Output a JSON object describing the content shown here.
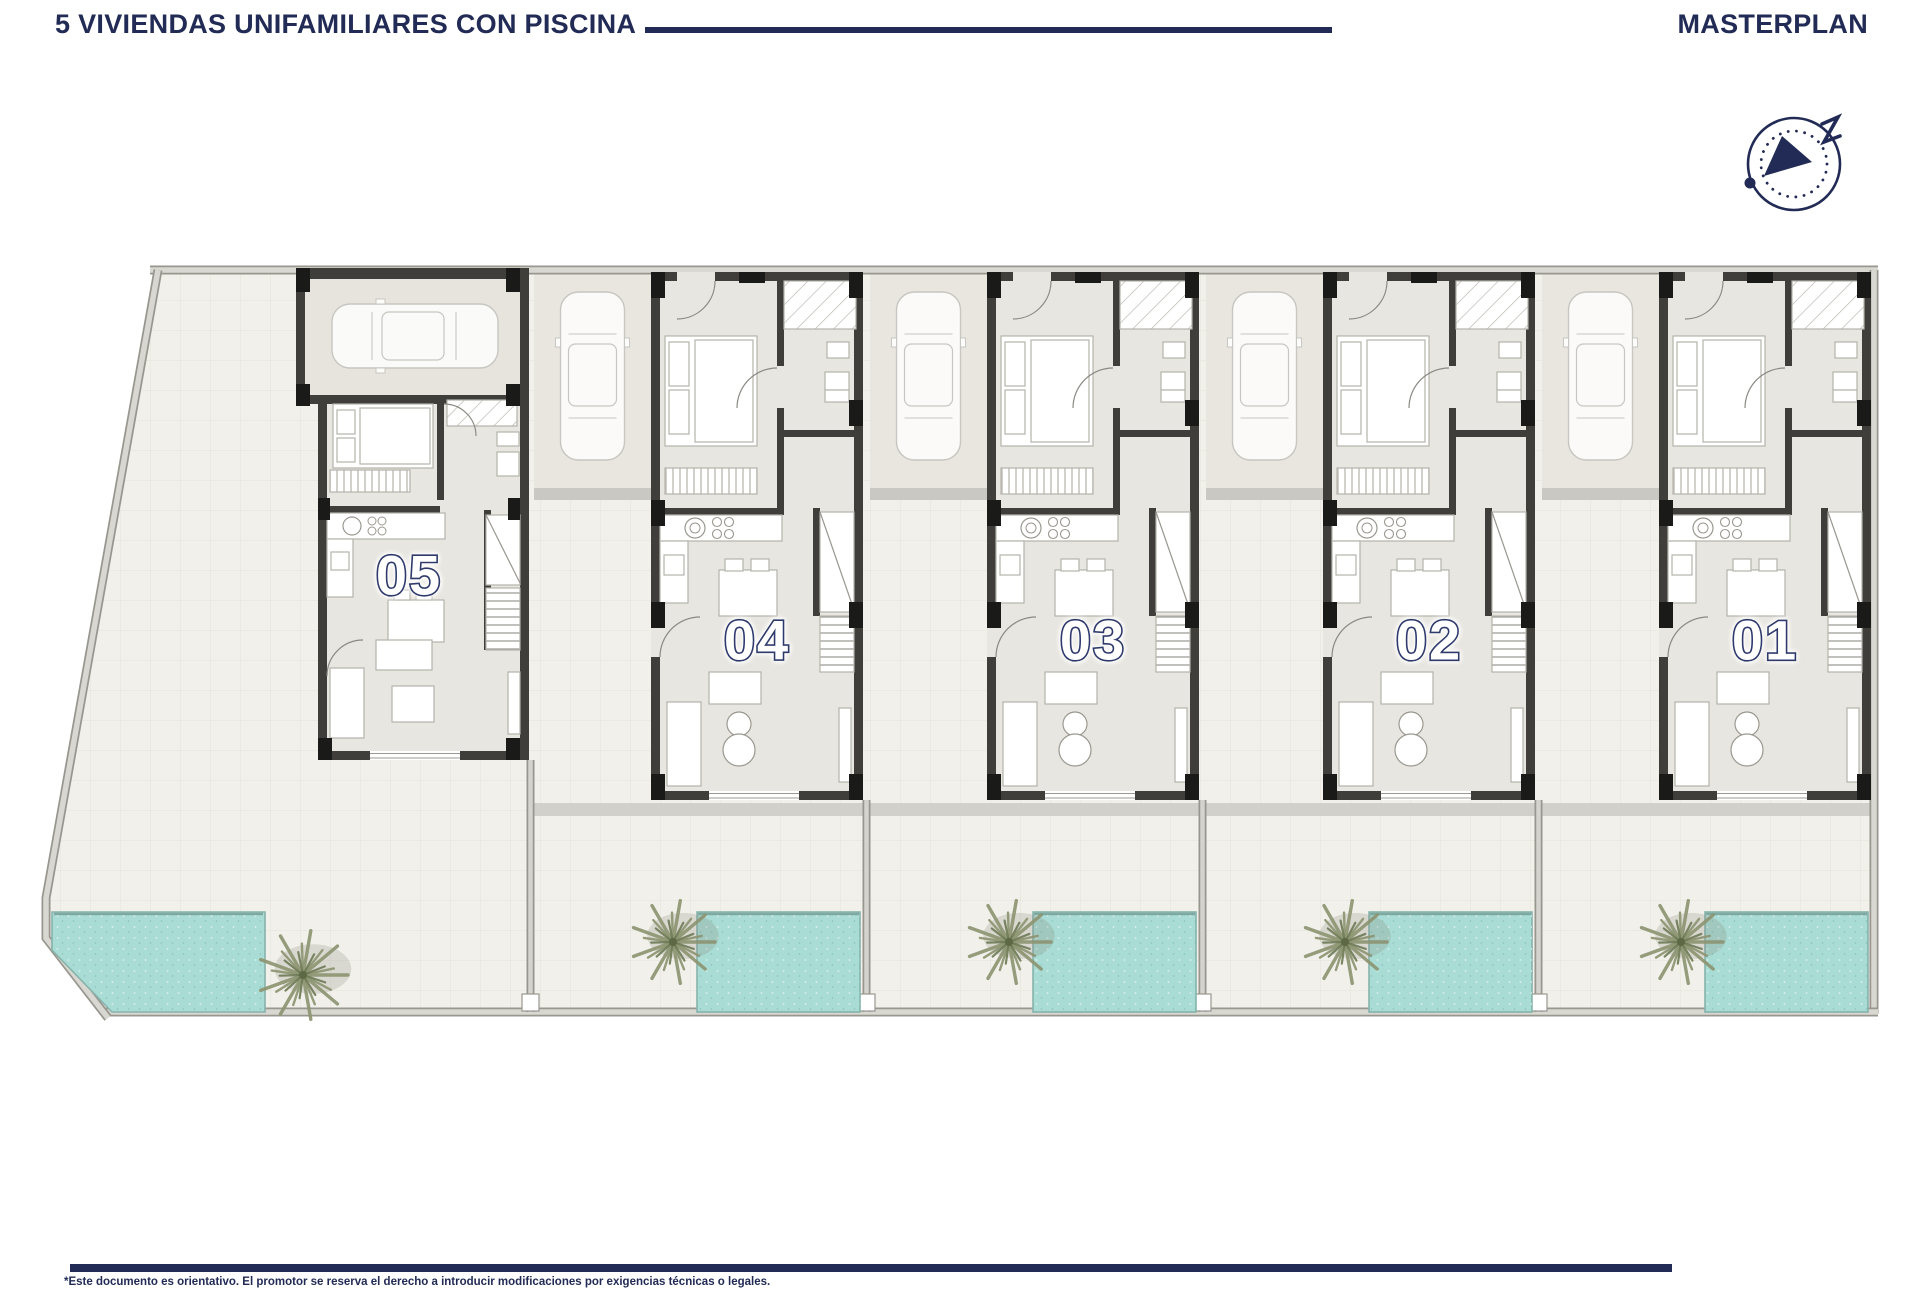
{
  "header": {
    "title": "5 VIVIENDAS UNIFAMILIARES CON PISCINA",
    "masterplan": "MASTERPLAN"
  },
  "site": {
    "units": [
      {
        "number": "05"
      },
      {
        "number": "04"
      },
      {
        "number": "03"
      },
      {
        "number": "02"
      },
      {
        "number": "01"
      }
    ]
  },
  "footer": {
    "disclaimer": "*Este documento es orientativo. El promotor se reserva el derecho a introducir modificaciones por exigencias técnicas o legales."
  },
  "colors": {
    "navy": "#222b55",
    "wall_dark": "#3f3e3b",
    "floor": "#e8e6e0",
    "paving": "#f1f0ea",
    "pool": "#a9dcd4",
    "palm": "#8d9572",
    "boundary": "#d8d7d1"
  }
}
